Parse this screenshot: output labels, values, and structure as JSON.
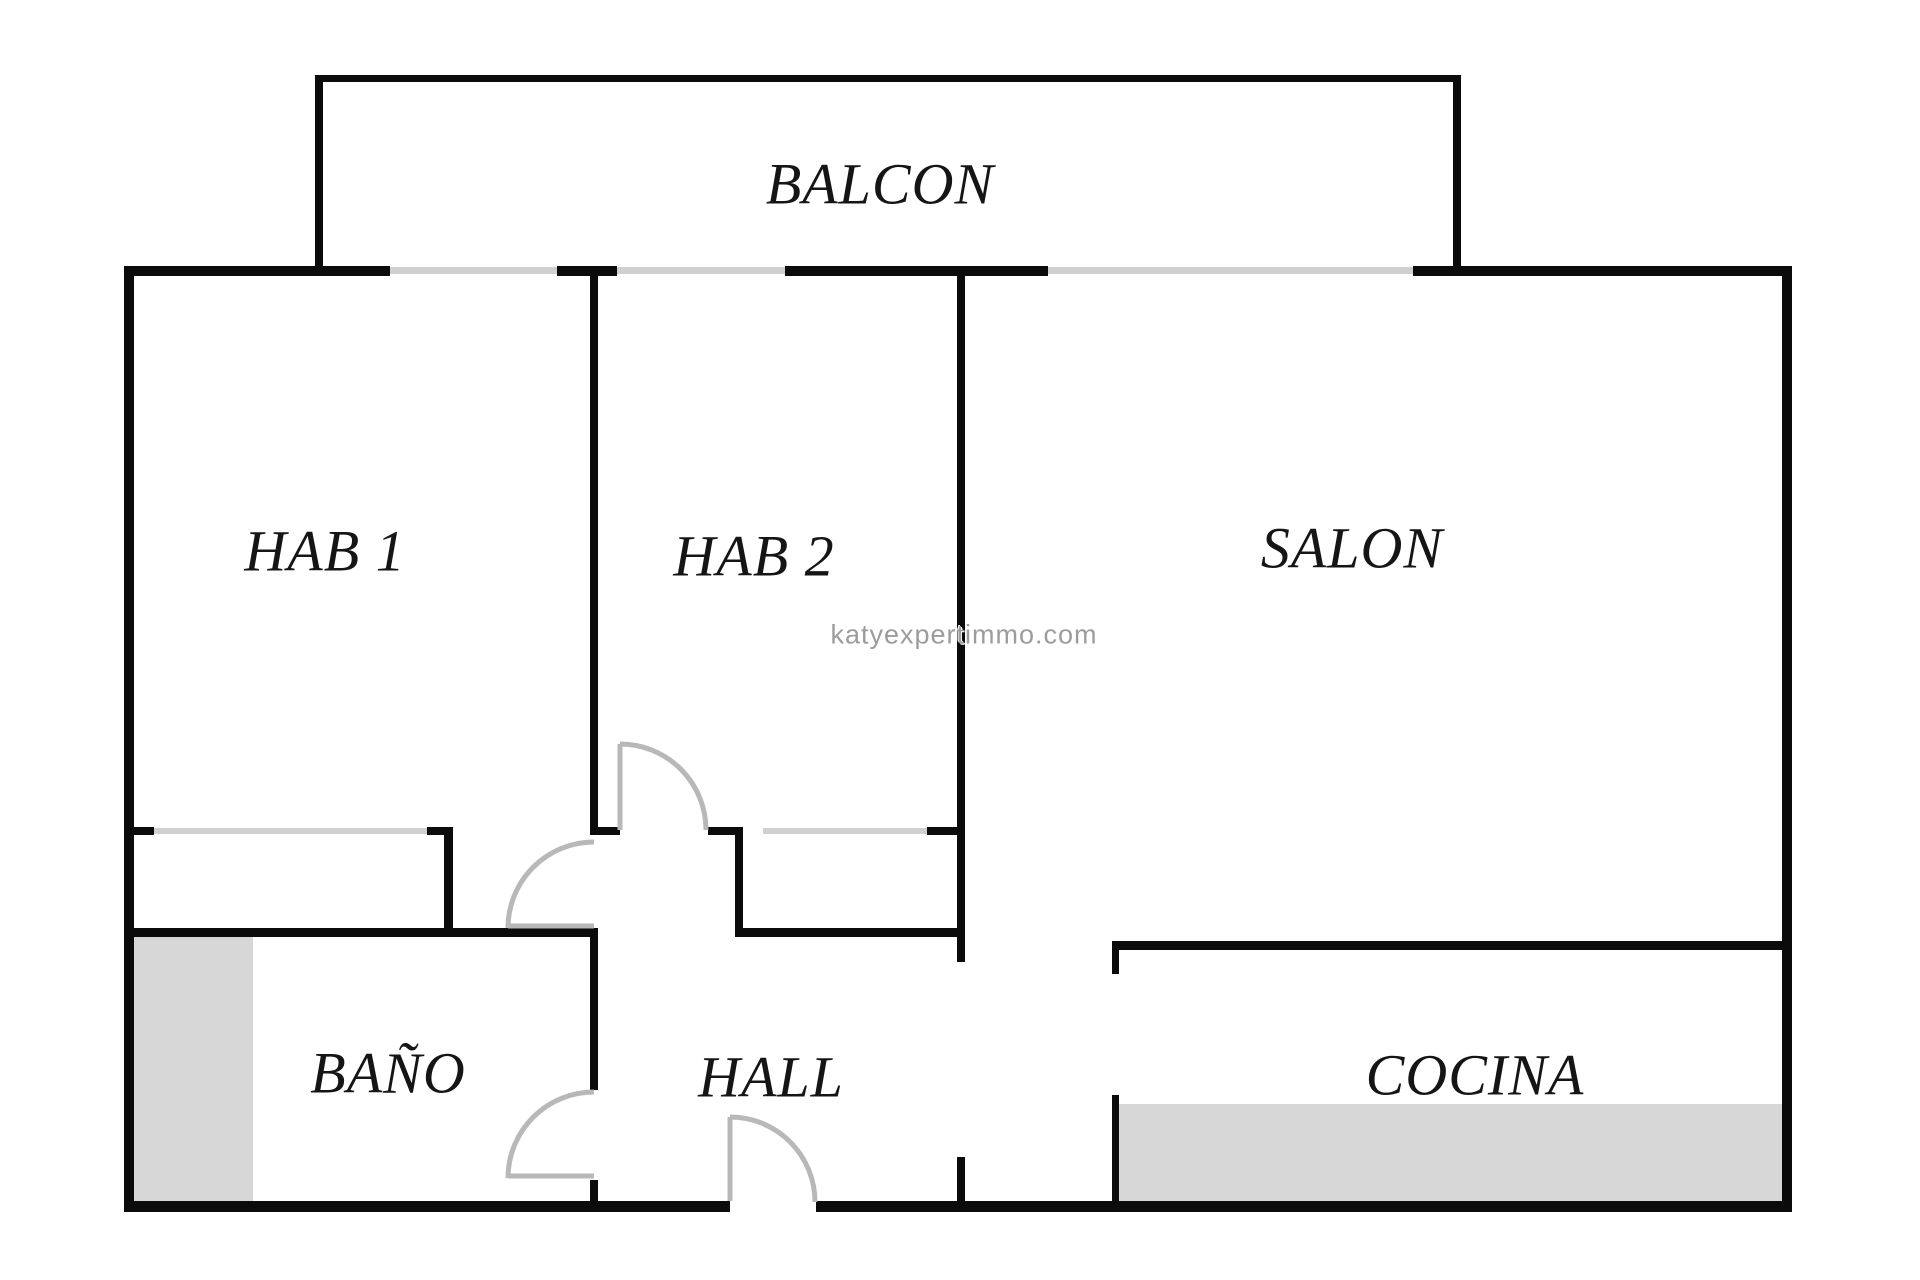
{
  "plan": {
    "title": "apartment-floorplan",
    "watermark": "katyexpertimmo.com",
    "rooms": {
      "balcon": {
        "label": "BALCON"
      },
      "hab1": {
        "label": "HAB 1"
      },
      "hab2": {
        "label": "HAB 2"
      },
      "salon": {
        "label": "SALON"
      },
      "bano": {
        "label": "BAÑO"
      },
      "hall": {
        "label": "HALL"
      },
      "cocina": {
        "label": "COCINA"
      }
    },
    "features": {
      "doors": [
        "hab1-door",
        "hab2-door",
        "bano-door",
        "entry-door"
      ],
      "windows": [
        "hab1-window",
        "hab2-window",
        "salon-window"
      ],
      "closets": [
        "hab1-closet",
        "hall-closet"
      ],
      "shaded_areas": [
        "bano-shower-area",
        "cocina-counter-area"
      ]
    },
    "colors": {
      "background": "#ffffff",
      "wall": "#0b0b0b",
      "window": "#d0d0d0",
      "door": "#b8b8b8",
      "floor_fill": "#d7d7d7",
      "label": "#151515",
      "watermark": "#9c9c9c"
    }
  }
}
